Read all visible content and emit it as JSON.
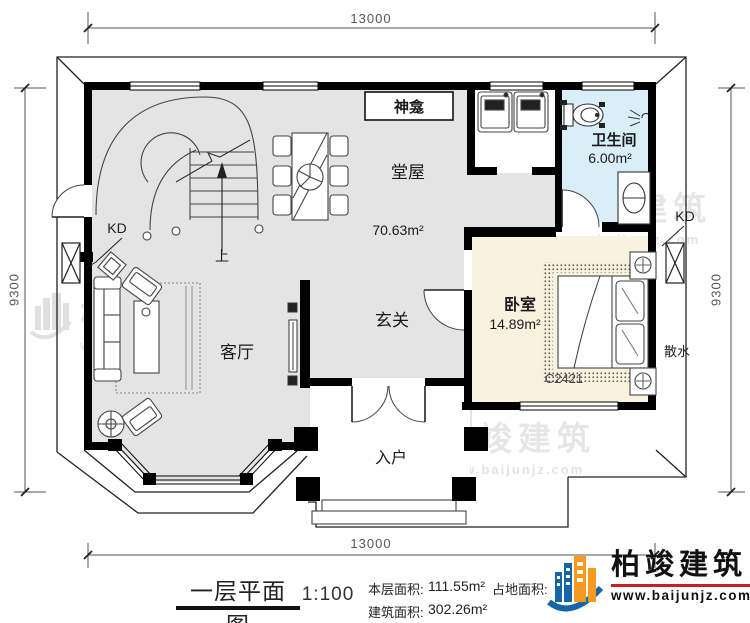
{
  "plan": {
    "rooms": {
      "hall": {
        "name": "堂屋",
        "area": "70.63m²"
      },
      "shrine": {
        "name": "神龛"
      },
      "bathroom": {
        "name": "卫生间",
        "area": "6.00m²"
      },
      "bedroom": {
        "name": "卧室",
        "area": "14.89m²"
      },
      "foyer": {
        "name": "玄关"
      },
      "living": {
        "name": "客厅"
      },
      "entry": {
        "name": "入户"
      }
    },
    "annotations": {
      "kd_left": "KD",
      "kd_right": "KD",
      "apron": "散水",
      "window_code": "C2421",
      "stairs_up": "上",
      "washer": "洗衣机"
    },
    "dimensions": {
      "top": "13000",
      "bottom": "13000",
      "left": "9300",
      "right": "9300"
    }
  },
  "title_block": {
    "plan_title": "一层平面图",
    "scale": "1:100",
    "floor_area_label": "本层面积:",
    "floor_area_value": "111.55m²",
    "build_area_label": "建筑面积:",
    "build_area_value": "302.26m²",
    "land_area_label": "占地面积:"
  },
  "brand": {
    "name": "柏竣建筑",
    "url": "www.baijunjz.com"
  },
  "watermark": {
    "name": "柏竣建筑",
    "url": "www.baijunjz.com"
  },
  "colors": {
    "floor": "#e4e4e4",
    "bathroom_floor": "#d9eff8",
    "bedroom_floor": "#f9f2df",
    "wall": "#000000",
    "logo_blue": "#1565a8",
    "logo_orange": "#f59a1f",
    "logo_red": "#c9201d"
  }
}
